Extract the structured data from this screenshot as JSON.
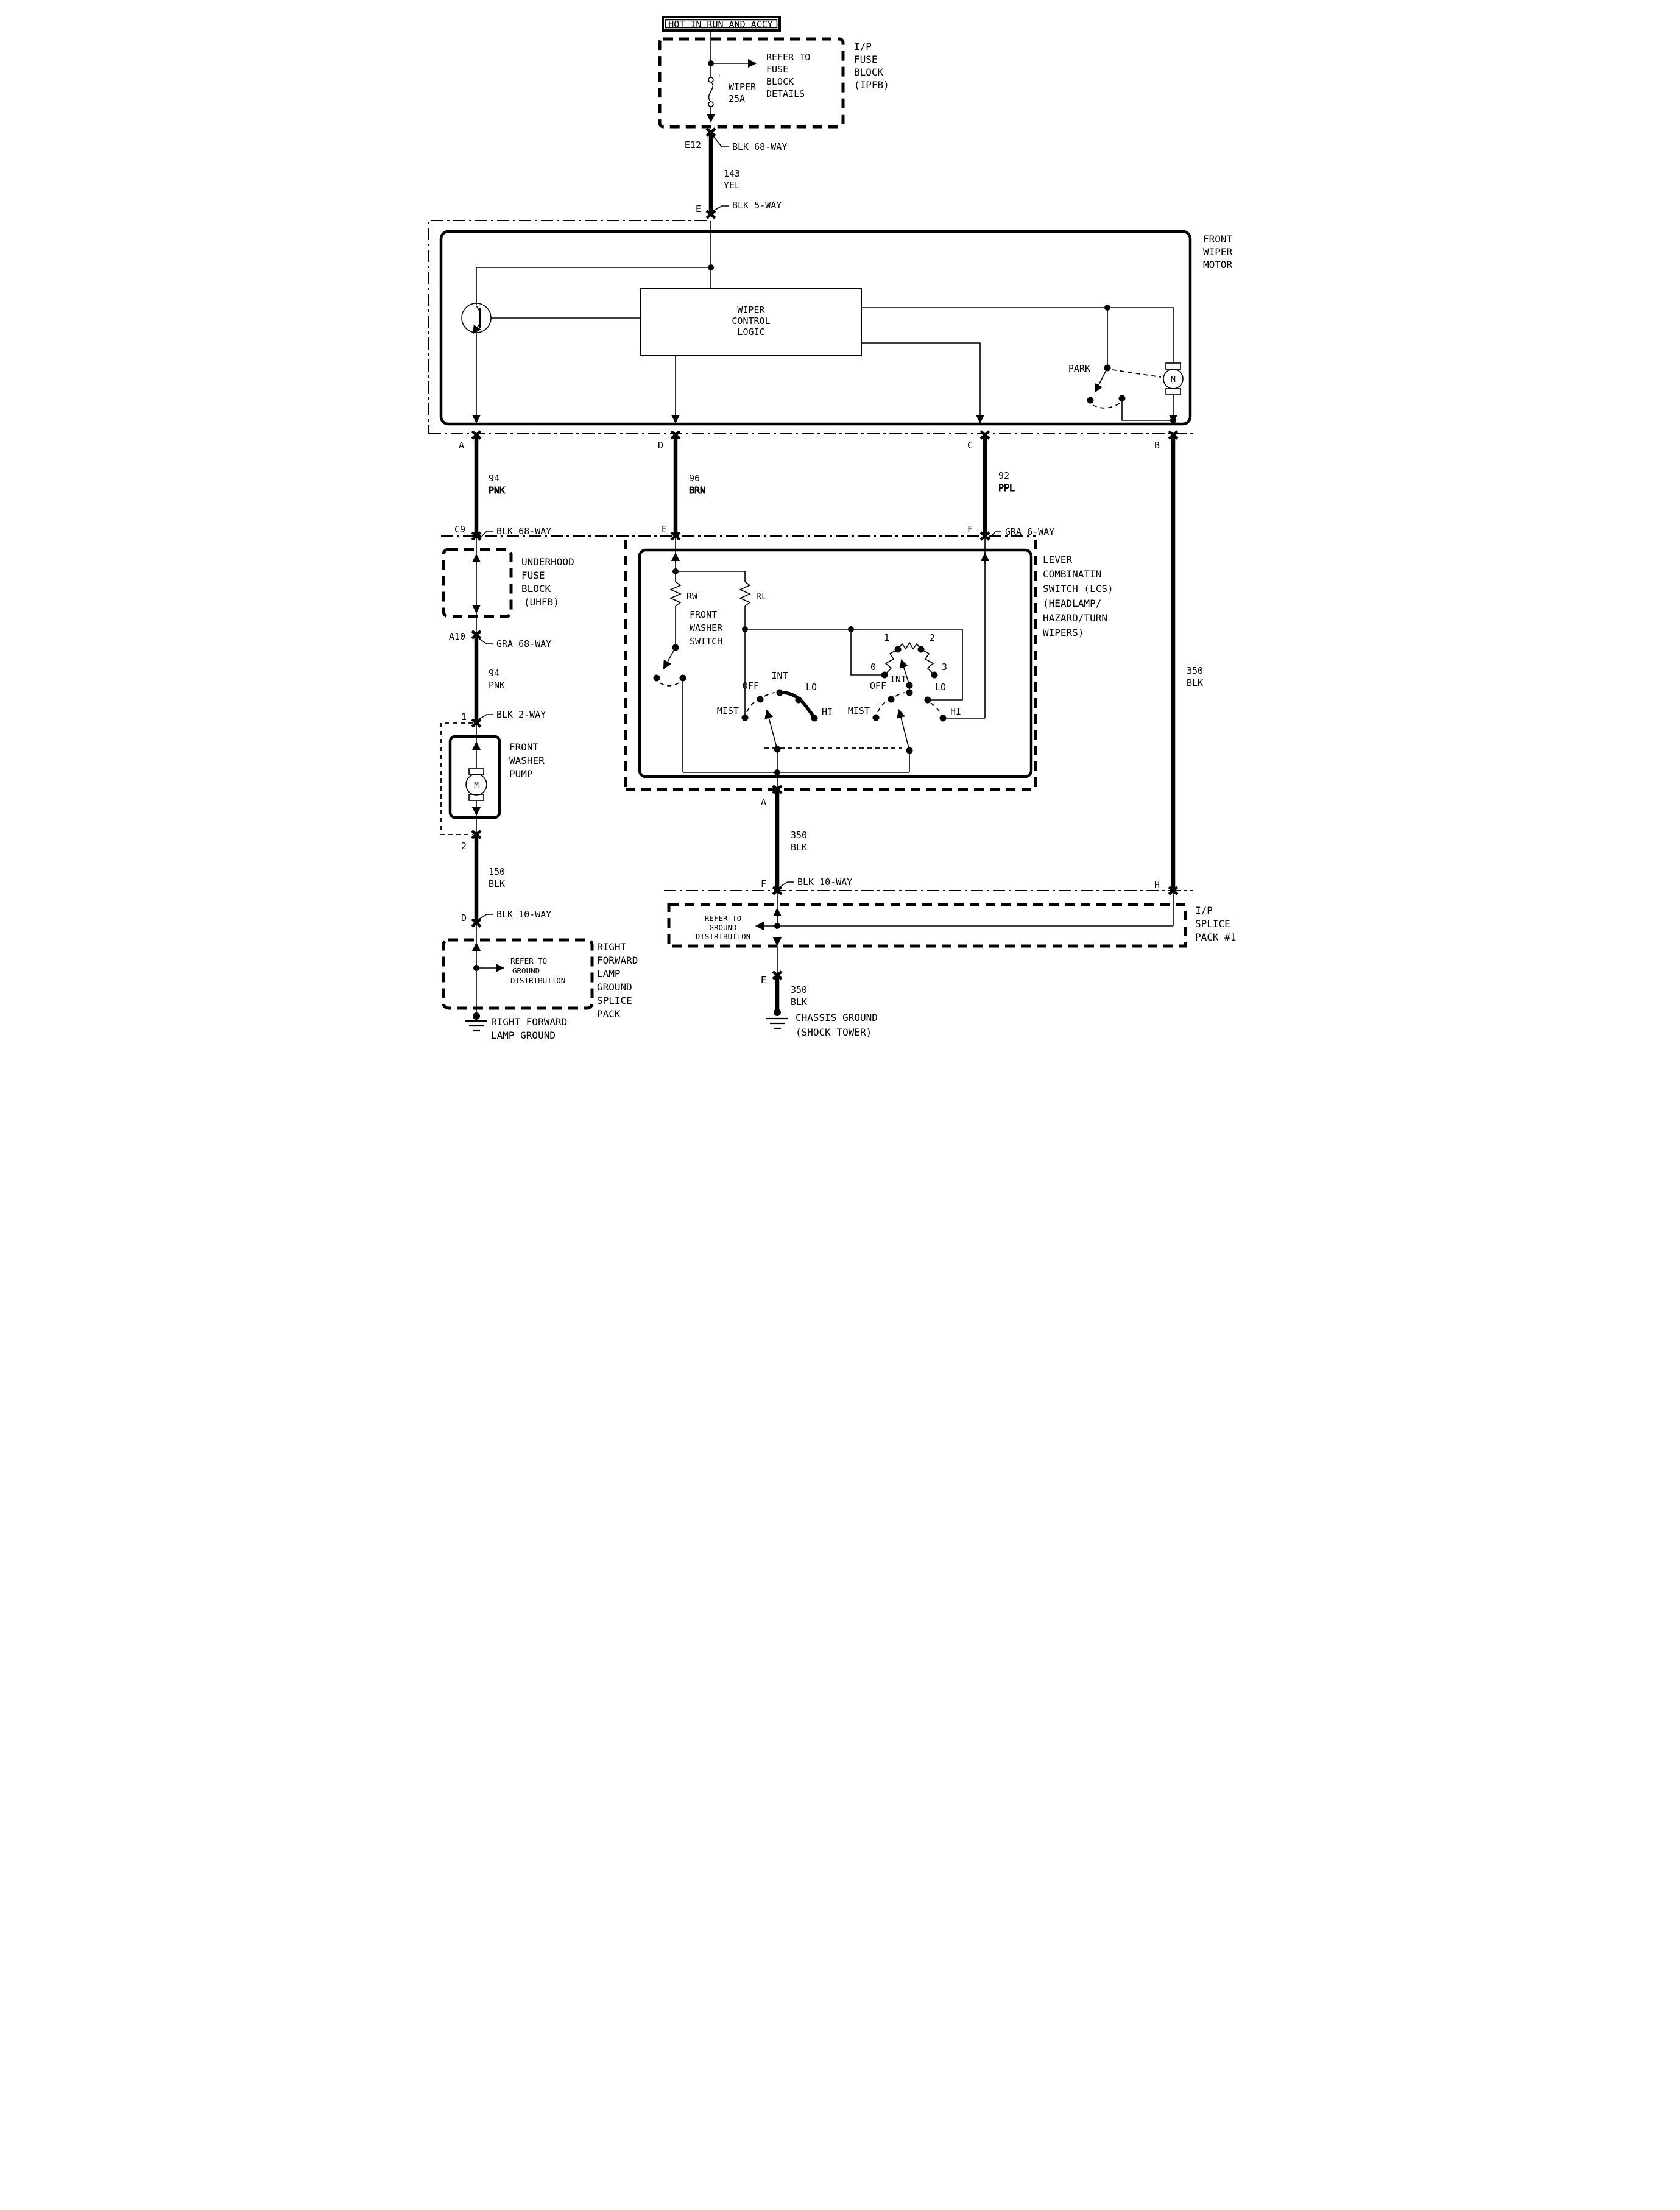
{
  "title_bar": {
    "label": "HOT IN RUN AND ACCY"
  },
  "ipfb": {
    "refer_lines": [
      "REFER TO",
      "FUSE",
      "BLOCK",
      "DETAILS"
    ],
    "fuse_plus": "+",
    "fuse_name": "WIPER",
    "fuse_rating": "25A",
    "block_lines": [
      "I/P",
      "FUSE",
      "BLOCK",
      "(IPFB)"
    ],
    "out_pin": "E12",
    "out_conn": "BLK 68-WAY",
    "wire": [
      "143",
      "YEL"
    ],
    "in_pin": "E",
    "in_conn": "BLK 5-WAY"
  },
  "wiper_motor": {
    "name_lines": [
      "FRONT",
      "WIPER",
      "MOTOR"
    ],
    "logic_lines": [
      "WIPER",
      "CONTROL",
      "LOGIC"
    ],
    "park_label": "PARK",
    "motor_letter": "M",
    "pins": {
      "a": "A",
      "d": "D",
      "c": "C",
      "b": "B"
    }
  },
  "wires": {
    "w94_top": [
      "94",
      "PNK"
    ],
    "w96": [
      "96",
      "BRN"
    ],
    "w92": [
      "92",
      "PPL"
    ],
    "w350_right": [
      "350",
      "BLK"
    ]
  },
  "uhfb": {
    "in_pin": "C9",
    "in_conn": "BLK 68-WAY",
    "name_lines": [
      "UNDERHOOD",
      "FUSE",
      "BLOCK",
      "(UHFB)"
    ],
    "out_pin": "A10",
    "out_conn": "GRA 68-WAY",
    "wire": [
      "94",
      "PNK"
    ]
  },
  "washer_pump": {
    "in_pin": "1",
    "in_conn": "BLK 2-WAY",
    "name_lines": [
      "FRONT",
      "WASHER",
      "PUMP"
    ],
    "motor_letter": "M",
    "out_pin": "2",
    "wire": [
      "150",
      "BLK"
    ],
    "conn_pin": "D",
    "conn_type": "BLK 10-WAY"
  },
  "rflg_splice": {
    "refer_lines": [
      "REFER TO",
      "GROUND",
      "DISTRIBUTION"
    ],
    "name_lines": [
      "RIGHT",
      "FORWARD",
      "LAMP",
      "GROUND",
      "SPLICE",
      "PACK"
    ],
    "ground_lines": [
      "RIGHT FORWARD",
      "LAMP GROUND"
    ]
  },
  "lcs": {
    "pin_e": "E",
    "pin_f": "F",
    "f_conn": "GRA 6-WAY",
    "name_lines": [
      "LEVER",
      "COMBINATIN",
      "SWITCH (LCS)",
      "(HEADLAMP/",
      "HAZARD/TURN",
      "WIPERS)"
    ],
    "rw": "RW",
    "rl": "RL",
    "washer_switch_lines": [
      "FRONT",
      "WASHER",
      "SWITCH"
    ],
    "delay_positions": [
      "0",
      "1",
      "2",
      "3"
    ],
    "sw_left": {
      "mist": "MIST",
      "off": "OFF",
      "int": "INT",
      "lo": "LO",
      "hi": "HI"
    },
    "sw_right": {
      "mist": "MIST",
      "off": "OFF",
      "int": "INT",
      "lo": "LO",
      "hi": "HI"
    },
    "out_pin": "A"
  },
  "ground_path": {
    "wire": [
      "350",
      "BLK"
    ],
    "pin_f": "F",
    "f_conn": "BLK 10-WAY",
    "pin_h": "H"
  },
  "ip_splice": {
    "refer_lines": [
      "REFER TO",
      "GROUND",
      "DISTRIBUTION"
    ],
    "name_lines": [
      "I/P",
      "SPLICE",
      "PACK #1"
    ],
    "out_pin": "E",
    "wire": [
      "350",
      "BLK"
    ],
    "ground_lines": [
      "CHASSIS GROUND",
      "(SHOCK TOWER)"
    ]
  }
}
